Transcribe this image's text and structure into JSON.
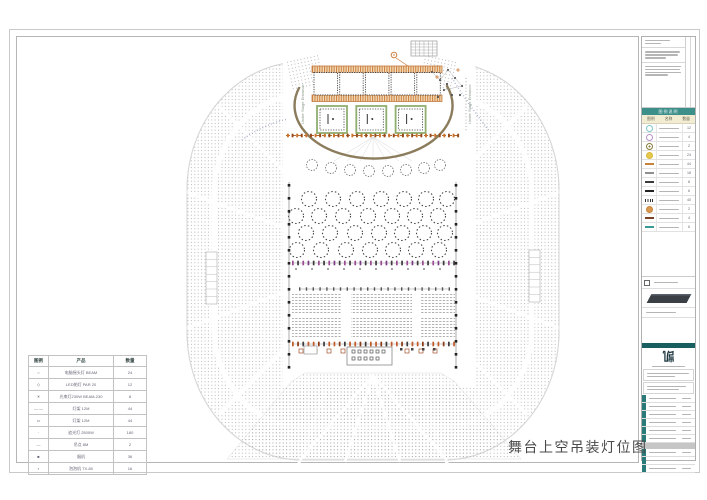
{
  "drawing": {
    "title": "舞台上空吊装灯位图",
    "stage_label_left": "Under Stage Entrance",
    "stage_label_right": "Under Stage Entrance"
  },
  "legend_table": {
    "headers": [
      "图例",
      "产品",
      "数量"
    ],
    "rows": [
      {
        "symbol": "○",
        "product": "电脑摇头灯 BEAM",
        "qty": "24"
      },
      {
        "symbol": "◇",
        "product": "LED帕灯 PAR 20",
        "qty": "12"
      },
      {
        "symbol": "✳",
        "product": "光束灯230W BEAM-230",
        "qty": "8"
      },
      {
        "symbol": "— —",
        "product": "灯架 12M",
        "qty": "44"
      },
      {
        "symbol": "▭",
        "product": "灯架 12M",
        "qty": "44"
      },
      {
        "symbol": "·",
        "product": "追光灯 2500W",
        "qty": "180"
      },
      {
        "symbol": "—",
        "product": "吊点 8M",
        "qty": "2"
      },
      {
        "symbol": "■",
        "product": "烟机",
        "qty": "36"
      },
      {
        "symbol": "▪",
        "product": "泡泡机 TX-80",
        "qty": "16"
      }
    ]
  },
  "title_strip": {
    "legend_header": "图例说明",
    "col_headers": [
      "图例",
      "名称",
      "数量"
    ],
    "legend_rows": [
      {
        "type": "circle",
        "color": "#7ec8c8",
        "fill": "none",
        "qty": "12"
      },
      {
        "type": "circle",
        "color": "#b890cc",
        "fill": "none",
        "qty": "4"
      },
      {
        "type": "circle-dot",
        "color": "#8a7a3a",
        "fill": "none",
        "qty": "2"
      },
      {
        "type": "circle",
        "color": "#d8b83a",
        "fill": "#e6c84e",
        "qty": "24"
      },
      {
        "type": "bar",
        "color": "#c8823c",
        "fill": "",
        "qty": "44"
      },
      {
        "type": "bar",
        "color": "#8f8f8f",
        "fill": "",
        "qty": "18"
      },
      {
        "type": "bar",
        "color": "#3a3a3a",
        "fill": "",
        "qty": "8"
      },
      {
        "type": "bar",
        "color": "#222222",
        "fill": "",
        "qty": "6"
      },
      {
        "type": "bar-dotted",
        "color": "#333333",
        "fill": "",
        "qty": "40"
      },
      {
        "type": "circle",
        "color": "#c8823c",
        "fill": "#d89a50",
        "qty": "2"
      },
      {
        "type": "bar",
        "color": "#7a4226",
        "fill": "",
        "qty": "4"
      },
      {
        "type": "bar",
        "color": "#3a9a94",
        "fill": "",
        "qty": "6"
      }
    ],
    "logo_text": "凯"
  },
  "colors": {
    "truss_orange": "#c8732e",
    "truss_green": "#8fae6f",
    "arc_brown": "#8b7c5c",
    "mark_purple": "#9a4a92",
    "mark_red": "#c05a28",
    "teal_accent": "#2a7a7a"
  }
}
